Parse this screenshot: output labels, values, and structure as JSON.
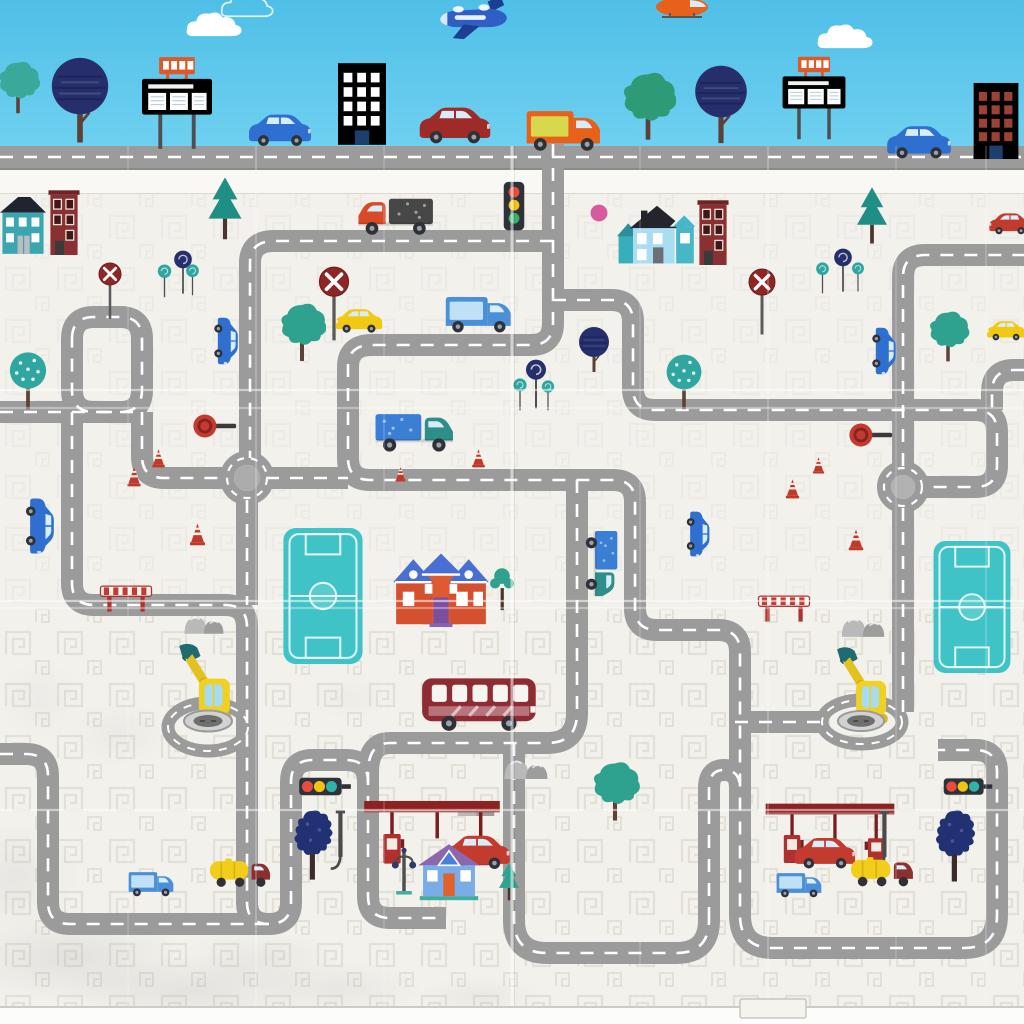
{
  "scene": {
    "size": {
      "w": 1024,
      "h": 1024
    },
    "colors": {
      "sky_top": "#4fbfe7",
      "sky_bottom": "#6fd0f0",
      "mat": "#f2f1ec",
      "band": "#f9f8f5",
      "edge": "#fcfcfa",
      "road_top": "#8a8a8a",
      "road": "#9b9b9b",
      "dash": "#ffffff",
      "pattern": "#e0ddd4"
    },
    "top_road": {
      "y": 146,
      "h": 24
    },
    "band": {
      "y": 170,
      "h": 23
    },
    "mat_bottom": 1007,
    "tab": {
      "x": 740,
      "y": 999,
      "w": 66,
      "h": 19
    },
    "roads": [
      "M0 157 H1024",
      "M553 144 V323 Q553 345 531 345 H372 Q348 345 348 367 V458 Q348 480 370 480 H613 Q635 480 635 502 V608 Q635 630 657 630 H718 Q740 630 740 652 V915 Q740 948 773 948 H964 Q997 948 997 915 V772 Q997 750 975 750 H938",
      "M577 480 V713 Q577 743 547 743 H390 Q368 743 368 773 V896 Q368 918 390 918 H446",
      "M553 241 H274 Q250 241 250 263 V458",
      "M553 300 H611 Q633 300 633 322 V388 Q633 410 655 410 H975 Q997 410 997 432 V465 Q997 487 975 487 H925",
      "M1024 370 H1014 Q992 370 992 392 V410",
      "M903 466 V277 Q903 255 925 255 H1024",
      "M903 508 V712",
      "M820 722 H729",
      "M142 412 V456 Q142 478 164 478 H228",
      "M266 478 H348",
      "M247 500 V605",
      "M72 412 V583 Q72 605 94 605 H225 Q247 605 247 627 V902 Q247 924 269 924",
      "M0 754 H26 Q48 754 48 776 V902 Q48 924 70 924 H269 Q291 924 291 902 V782 Q291 760 313 760 H346 Q368 760 368 782",
      "M514 743 V920 Q514 953 547 953 H676 Q709 953 709 920",
      "M709 920 V788 Q709 770 724 770 Q740 770 740 788",
      "M0 412 H142",
      "M72 339 Q72 317 94 317 H120 Q142 317 142 339 V390 Q142 412 120 412 H94 Q72 412 72 390 Z"
    ],
    "rings": [
      {
        "cx": 247,
        "cy": 478,
        "r": 20,
        "inner": 13,
        "ic": "#acacac"
      },
      {
        "cx": 903,
        "cy": 487,
        "r": 19,
        "inner": 12,
        "ic": "#b2b2b2"
      }
    ],
    "ovals": [
      {
        "cx": 208,
        "cy": 727,
        "rx": 40,
        "ry": 24
      },
      {
        "cx": 862,
        "cy": 722,
        "rx": 40,
        "ry": 22
      }
    ],
    "creases": {
      "h": [
        [
          390,
          0.5
        ],
        [
          408,
          0.35
        ],
        [
          601,
          0.55
        ],
        [
          608,
          0.35
        ],
        [
          810,
          0.5
        ]
      ],
      "v": [
        [
          512,
          0.55
        ],
        [
          256,
          0.22
        ],
        [
          768,
          0.22
        ],
        [
          128,
          0.15
        ],
        [
          384,
          0.15
        ],
        [
          640,
          0.15
        ],
        [
          896,
          0.15
        ],
        [
          986,
          0.18
        ]
      ]
    },
    "grunge": [
      [
        70,
        958,
        115,
        46,
        0.32
      ],
      [
        190,
        990,
        130,
        34,
        0.3
      ],
      [
        15,
        878,
        65,
        55,
        0.22
      ],
      [
        338,
        988,
        85,
        26,
        0.22
      ],
      [
        118,
        733,
        50,
        34,
        0.14
      ],
      [
        40,
        700,
        40,
        40,
        0.12
      ],
      [
        350,
        698,
        38,
        22,
        0.1
      ],
      [
        260,
        960,
        80,
        30,
        0.2
      ],
      [
        480,
        996,
        60,
        20,
        0.18
      ]
    ],
    "items": [
      {
        "s": "cloud",
        "x": 184,
        "y": 10,
        "w": 62,
        "h": 28,
        "n": "cloud"
      },
      {
        "s": "cloudo",
        "x": 206,
        "y": -8,
        "w": 84,
        "h": 26,
        "n": "cloud-outline"
      },
      {
        "s": "cloud",
        "x": 814,
        "y": 22,
        "w": 64,
        "h": 28,
        "n": "cloud"
      },
      {
        "s": "plane",
        "x": 436,
        "y": -4,
        "w": 74,
        "h": 44,
        "n": "airplane"
      },
      {
        "s": "heli",
        "x": 648,
        "y": -8,
        "w": 68,
        "h": 26,
        "n": "helicopter"
      },
      {
        "s": "bushy",
        "x": -10,
        "y": 58,
        "w": 56,
        "h": 60,
        "c": "#3aa89b",
        "n": "tree-bushy"
      },
      {
        "s": "round",
        "x": 46,
        "y": 56,
        "w": 68,
        "h": 94,
        "c": "#262f6b",
        "n": "tree-round"
      },
      {
        "s": "billboard",
        "x": 138,
        "y": 54,
        "w": 78,
        "h": 98,
        "n": "billboard"
      },
      {
        "s": "bldgo",
        "x": 334,
        "y": 60,
        "w": 56,
        "h": 88,
        "a": "#ffffff",
        "n": "building-orange"
      },
      {
        "s": "car",
        "x": 414,
        "y": 100,
        "w": 82,
        "h": 48,
        "c": "#9e2b28",
        "n": "car-darkred"
      },
      {
        "s": "car",
        "x": 244,
        "y": 109,
        "w": 72,
        "h": 40,
        "c": "#2f6fd0",
        "n": "car-blue"
      },
      {
        "s": "van",
        "x": 522,
        "y": 106,
        "w": 86,
        "h": 46,
        "c": "#e8611a",
        "a": "#d8d84e",
        "n": "van-orange"
      },
      {
        "s": "bushy",
        "x": 620,
        "y": 64,
        "w": 56,
        "h": 86,
        "c": "#2e9b76",
        "n": "tree-bushy"
      },
      {
        "s": "round",
        "x": 688,
        "y": 64,
        "w": 66,
        "h": 86,
        "c": "#262f6b",
        "n": "tree-round"
      },
      {
        "s": "billboard",
        "x": 772,
        "y": 54,
        "w": 84,
        "h": 88,
        "n": "billboard"
      },
      {
        "s": "car",
        "x": 882,
        "y": 122,
        "w": 74,
        "h": 38,
        "c": "#2f6fd0",
        "n": "car-blue"
      },
      {
        "s": "bldgo",
        "x": 969,
        "y": 80,
        "w": 54,
        "h": 82,
        "a": "#9c4136",
        "n": "building-orange"
      },
      {
        "s": "houseA",
        "x": 0,
        "y": 194,
        "w": 46,
        "h": 64,
        "n": "house-teal"
      },
      {
        "s": "bldgr",
        "x": 45,
        "y": 189,
        "w": 38,
        "h": 66,
        "n": "building-red"
      },
      {
        "s": "pine",
        "x": 199,
        "y": 176,
        "w": 52,
        "h": 66,
        "c": "#1f8f85",
        "n": "tree-pine"
      },
      {
        "s": "lolli",
        "x": 168,
        "y": 250,
        "w": 30,
        "h": 46,
        "c": "#262f6b",
        "n": "tree-lollipop"
      },
      {
        "s": "lolli",
        "x": 153,
        "y": 264,
        "w": 23,
        "h": 35,
        "c": "#2fa7a0",
        "n": "tree-lollipop"
      },
      {
        "s": "lolli",
        "x": 182,
        "y": 264,
        "w": 21,
        "h": 33,
        "c": "#2fa7a0",
        "n": "tree-lollipop"
      },
      {
        "s": "noentry",
        "x": 97,
        "y": 262,
        "w": 26,
        "h": 58,
        "n": "no-entry-sign"
      },
      {
        "s": "noentry",
        "x": 315,
        "y": 266,
        "w": 38,
        "h": 76,
        "n": "no-entry-sign"
      },
      {
        "s": "truck",
        "x": 346,
        "y": 192,
        "w": 96,
        "h": 44,
        "f": 1,
        "c": "#d94a28",
        "a": "#474747",
        "n": "pickup-truck-red"
      },
      {
        "s": "houseB",
        "x": 616,
        "y": 201,
        "w": 82,
        "h": 64,
        "n": "house-blue"
      },
      {
        "s": "bldgr",
        "x": 694,
        "y": 199,
        "w": 38,
        "h": 66,
        "n": "building-red"
      },
      {
        "s": "pine",
        "x": 848,
        "y": 186,
        "w": 48,
        "h": 60,
        "c": "#1f8f85",
        "n": "tree-pine"
      },
      {
        "s": "lolli",
        "x": 828,
        "y": 248,
        "w": 30,
        "h": 46,
        "c": "#262f6b",
        "n": "tree-lollipop"
      },
      {
        "s": "lolli",
        "x": 811,
        "y": 262,
        "w": 23,
        "h": 33,
        "c": "#2fa7a0",
        "n": "tree-lollipop"
      },
      {
        "s": "lolli",
        "x": 848,
        "y": 262,
        "w": 20,
        "h": 31,
        "c": "#2fa7a0",
        "n": "tree-lollipop"
      },
      {
        "s": "noentry",
        "x": 746,
        "y": 268,
        "w": 32,
        "h": 68,
        "n": "no-entry-sign"
      },
      {
        "s": "car",
        "x": 986,
        "y": 206,
        "w": 48,
        "h": 34,
        "f": 1,
        "c": "#c23b2e",
        "n": "car-red"
      },
      {
        "s": "dot",
        "x": 590,
        "y": 204,
        "w": 18,
        "h": 18,
        "c": "#d65b9e",
        "n": "balloon-dot"
      },
      {
        "s": "car",
        "x": 211,
        "y": 314,
        "w": 32,
        "h": 54,
        "r": 90,
        "c": "#2f6fd0",
        "n": "car-blue"
      },
      {
        "s": "bushy",
        "x": 278,
        "y": 296,
        "w": 48,
        "h": 74,
        "c": "#2fa28f",
        "n": "tree-bushy"
      },
      {
        "s": "car",
        "x": 332,
        "y": 301,
        "w": 54,
        "h": 38,
        "f": 1,
        "c": "#f2c912",
        "n": "car-yellow"
      },
      {
        "s": "van",
        "x": 442,
        "y": 291,
        "w": 76,
        "h": 44,
        "c": "#4a90d9",
        "a": "#bfe0f6",
        "n": "van-blue"
      },
      {
        "s": "round",
        "x": 576,
        "y": 326,
        "w": 36,
        "h": 50,
        "c": "#262f6b",
        "n": "tree-round"
      },
      {
        "s": "lolli",
        "x": 519,
        "y": 359,
        "w": 34,
        "h": 52,
        "c": "#262f6b",
        "n": "tree-lollipop"
      },
      {
        "s": "lolli",
        "x": 510,
        "y": 378,
        "w": 20,
        "h": 34,
        "c": "#2fa7a0",
        "n": "tree-lollipop"
      },
      {
        "s": "lolli",
        "x": 539,
        "y": 380,
        "w": 18,
        "h": 32,
        "c": "#2fa7a0",
        "n": "tree-lollipop"
      },
      {
        "s": "dottree",
        "x": 662,
        "y": 354,
        "w": 44,
        "h": 60,
        "c": "#2fa7a0",
        "n": "tree-dotted"
      },
      {
        "s": "bushy",
        "x": 926,
        "y": 308,
        "w": 44,
        "h": 58,
        "c": "#2fa28f",
        "n": "tree-bushy"
      },
      {
        "s": "car",
        "x": 984,
        "y": 312,
        "w": 44,
        "h": 36,
        "f": 1,
        "c": "#f2c912",
        "n": "car-yellow"
      },
      {
        "s": "car",
        "x": 868,
        "y": 324,
        "w": 34,
        "h": 54,
        "r": 90,
        "c": "#2f6fd0",
        "n": "car-blue"
      },
      {
        "s": "paddle",
        "x": 192,
        "y": 411,
        "w": 46,
        "h": 30,
        "n": "stop-paddle-sign"
      },
      {
        "s": "paddle",
        "x": 848,
        "y": 420,
        "w": 46,
        "h": 30,
        "n": "stop-paddle-sign"
      },
      {
        "s": "cone",
        "x": 150,
        "y": 448,
        "w": 17,
        "h": 20,
        "n": "traffic-cone"
      },
      {
        "s": "cone",
        "x": 126,
        "y": 466,
        "w": 16,
        "h": 21,
        "n": "traffic-cone"
      },
      {
        "s": "cone",
        "x": 188,
        "y": 522,
        "w": 19,
        "h": 24,
        "n": "traffic-cone"
      },
      {
        "s": "cone",
        "x": 470,
        "y": 448,
        "w": 17,
        "h": 20,
        "n": "traffic-cone"
      },
      {
        "s": "cone",
        "x": 394,
        "y": 466,
        "w": 13,
        "h": 16,
        "n": "traffic-cone"
      },
      {
        "s": "cone",
        "x": 811,
        "y": 456,
        "w": 15,
        "h": 18,
        "n": "traffic-cone"
      },
      {
        "s": "cone",
        "x": 784,
        "y": 478,
        "w": 17,
        "h": 21,
        "n": "traffic-cone"
      },
      {
        "s": "cone",
        "x": 847,
        "y": 528,
        "w": 18,
        "h": 23,
        "n": "traffic-cone"
      },
      {
        "s": "truck",
        "x": 372,
        "y": 406,
        "w": 88,
        "h": 48,
        "c": "#2e8f8a",
        "a": "#3b7fd4",
        "n": "truck-teal"
      },
      {
        "s": "barrier",
        "x": 96,
        "y": 581,
        "w": 60,
        "h": 34,
        "n": "road-barrier"
      },
      {
        "s": "barrier",
        "x": 756,
        "y": 591,
        "w": 56,
        "h": 34,
        "n": "road-barrier"
      },
      {
        "s": "rocks",
        "x": 182,
        "y": 606,
        "w": 44,
        "h": 30,
        "n": "rocks"
      },
      {
        "s": "rocks",
        "x": 839,
        "y": 608,
        "w": 48,
        "h": 30,
        "n": "rocks"
      },
      {
        "s": "rocks",
        "x": 452,
        "y": 792,
        "w": 48,
        "h": 24,
        "n": "rocks"
      },
      {
        "s": "rocks",
        "x": 501,
        "y": 751,
        "w": 50,
        "h": 28,
        "n": "rocks"
      },
      {
        "s": "field",
        "x": 282,
        "y": 527,
        "w": 82,
        "h": 138,
        "n": "soccer-field"
      },
      {
        "s": "field",
        "x": 932,
        "y": 540,
        "w": 80,
        "h": 134,
        "n": "soccer-field"
      },
      {
        "s": "houseC",
        "x": 392,
        "y": 544,
        "w": 98,
        "h": 84,
        "n": "house-red-blueroof"
      },
      {
        "s": "sapling",
        "x": 490,
        "y": 566,
        "w": 24,
        "h": 46,
        "c": "#2fa28f",
        "n": "sapling"
      },
      {
        "s": "excav",
        "x": 176,
        "y": 638,
        "w": 62,
        "h": 96,
        "n": "excavator"
      },
      {
        "s": "excav",
        "x": 834,
        "y": 640,
        "w": 60,
        "h": 96,
        "n": "excavator"
      },
      {
        "s": "manhole",
        "x": 182,
        "y": 708,
        "w": 52,
        "h": 26,
        "n": "manhole"
      },
      {
        "s": "manhole",
        "x": 836,
        "y": 708,
        "w": 50,
        "h": 26,
        "n": "manhole"
      },
      {
        "s": "truck",
        "x": 580,
        "y": 528,
        "w": 48,
        "h": 74,
        "r": 90,
        "c": "#2e8f8a",
        "a": "#3b7fd4",
        "n": "truck-teal"
      },
      {
        "s": "car",
        "x": 682,
        "y": 508,
        "w": 34,
        "h": 52,
        "r": 90,
        "c": "#2f6fd0",
        "n": "car-blue"
      },
      {
        "s": "bus",
        "x": 420,
        "y": 674,
        "w": 120,
        "h": 58,
        "c": "#8e2b33",
        "n": "bus-darkred"
      },
      {
        "s": "car",
        "x": 22,
        "y": 494,
        "w": 38,
        "h": 64,
        "r": 90,
        "c": "#2f6fd0",
        "n": "car-blue"
      },
      {
        "s": "gas",
        "x": 356,
        "y": 794,
        "w": 152,
        "h": 80,
        "n": "gas-station"
      },
      {
        "s": "pole",
        "x": 326,
        "y": 810,
        "w": 28,
        "h": 62,
        "n": "fuel-pump-pole"
      },
      {
        "s": "car",
        "x": 438,
        "y": 832,
        "w": 78,
        "h": 38,
        "c": "#c23b2e",
        "n": "car-red"
      },
      {
        "s": "tanker",
        "x": 208,
        "y": 852,
        "w": 66,
        "h": 38,
        "c": "#f2cd1a",
        "a": "#8c2f2f",
        "n": "tanker-truck-yellow"
      },
      {
        "s": "van",
        "x": 126,
        "y": 866,
        "w": 52,
        "h": 34,
        "c": "#4a90d9",
        "a": "#bfe0f6",
        "n": "van-blue"
      },
      {
        "s": "gas",
        "x": 764,
        "y": 796,
        "w": 132,
        "h": 78,
        "n": "gas-station"
      },
      {
        "s": "pole",
        "x": 870,
        "y": 810,
        "w": 28,
        "h": 62,
        "n": "fuel-pump-pole"
      },
      {
        "s": "car",
        "x": 790,
        "y": 834,
        "w": 70,
        "h": 36,
        "c": "#c23b2e",
        "n": "car-red"
      },
      {
        "s": "tanker",
        "x": 849,
        "y": 851,
        "w": 68,
        "h": 38,
        "c": "#f2cd1a",
        "a": "#8c2f2f",
        "n": "tanker-truck-yellow"
      },
      {
        "s": "van",
        "x": 774,
        "y": 868,
        "w": 52,
        "h": 32,
        "c": "#4a90d9",
        "a": "#bfe0f6",
        "n": "van-blue"
      },
      {
        "s": "tlh",
        "x": 296,
        "y": 775,
        "w": 58,
        "h": 24,
        "n": "traffic-light"
      },
      {
        "s": "tlh",
        "x": 942,
        "y": 775,
        "w": 52,
        "h": 24,
        "n": "traffic-light"
      },
      {
        "s": "navybumpy",
        "x": 288,
        "y": 808,
        "w": 48,
        "h": 76,
        "c": "#223173",
        "n": "tree-navy"
      },
      {
        "s": "navybumpy",
        "x": 932,
        "y": 808,
        "w": 44,
        "h": 78,
        "c": "#223173",
        "n": "tree-navy"
      },
      {
        "s": "lamp",
        "x": 390,
        "y": 846,
        "w": 28,
        "h": 52,
        "n": "street-lamp"
      },
      {
        "s": "houseD",
        "x": 416,
        "y": 841,
        "w": 66,
        "h": 60,
        "n": "house-blue-purpleroof"
      },
      {
        "s": "pine",
        "x": 492,
        "y": 862,
        "w": 34,
        "h": 40,
        "c": "#2fa28f",
        "n": "tree-pine"
      },
      {
        "s": "tlv",
        "x": 500,
        "y": 180,
        "w": 28,
        "h": 56,
        "n": "traffic-light"
      },
      {
        "s": "dottree",
        "x": 8,
        "y": 349,
        "w": 40,
        "h": 68,
        "c": "#2fa7a0",
        "n": "tree-dotted"
      },
      {
        "s": "bushy",
        "x": 590,
        "y": 758,
        "w": 50,
        "h": 68,
        "c": "#2fa28f",
        "n": "tree-bushy"
      }
    ]
  }
}
